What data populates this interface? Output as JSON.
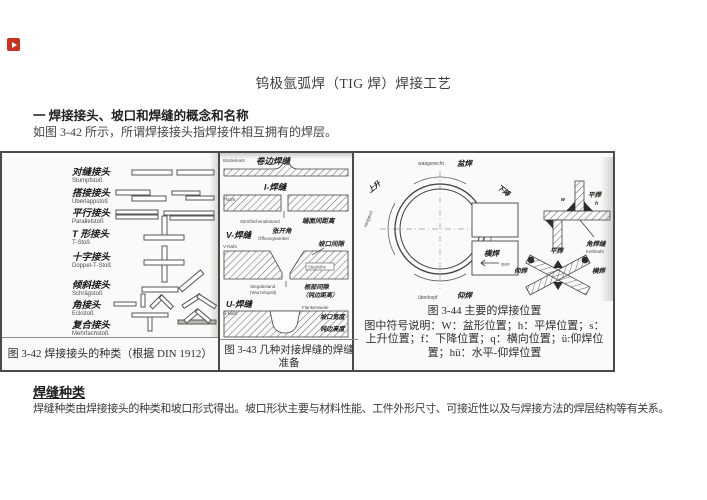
{
  "watermark": {
    "color": "#c8311f"
  },
  "title": "钨极氩弧焊（TIG 焊）焊接工艺",
  "section": {
    "heading": "一  焊接接头、坡口和焊缝的概念和名称",
    "intro": "如图 3-42 所示，所谓焊接接头指焊接件相互拥有的焊层。"
  },
  "figure_table": {
    "col1": {
      "caption": "图 3-42  焊接接头的种类（根据 DIN 1912）",
      "joints": [
        {
          "zh": "对缝接头",
          "de": "Stumpfstoß"
        },
        {
          "zh": "搭接接头",
          "de": "Überlappstoß"
        },
        {
          "zh": "平行接头",
          "de": "Parallelstoß"
        },
        {
          "zh": "T 形接头",
          "de": "T-Stoß"
        },
        {
          "zh": "十字接头",
          "de": "Doppel-T-Stoß"
        },
        {
          "zh": "倾斜接头",
          "de": "Schrägstoß"
        },
        {
          "zh": "角接头",
          "de": "Eckstoß"
        },
        {
          "zh": "复合接头",
          "de": "Mehrfachstoß"
        }
      ]
    },
    "col2": {
      "caption": "图 3-43  几种对接焊缝的焊缝准备",
      "labels": {
        "bordel_de": "Bördelnaht",
        "bordel_zh": "卷边焊缝",
        "i_zh": "I-焊缝",
        "i_de": "I-Naht",
        "gap_de": "Stirnflächenabstand",
        "gap_zh": "端面间距离",
        "angle_zh": "张开角",
        "angle_de": "Öffnungswinkel",
        "v_zh": "V-焊缝",
        "v_de": "V-Naht",
        "groove_zh": "坡口间隙",
        "steg_de": "Steghöhe",
        "root_de1": "Stegabstand",
        "root_de2": "(Wurzelspalt)",
        "root_zh1": "根部间隙",
        "root_zh2": "（钝边距离）",
        "u_zh": "U-焊缝",
        "u_de": "U-Naht",
        "flank_de": "Flankenweite",
        "flank_zh": "坡口宽度",
        "blunt_zh": "钝边高度"
      }
    },
    "col3": {
      "caption_title": "图 3-44  主要的焊接位置",
      "caption_legend": "图中符号说明：W：盆形位置；h：平焊位置；s：上升位置；f：下降位置；q：横向位置；ü:仰焊位置；hü：水平-仰焊位置",
      "labels": {
        "top_de": "waagerecht",
        "top_zh": "盆焊",
        "left_zh": "上升",
        "left_de": "steigend",
        "right_zh": "下降",
        "right_de": "fallend",
        "bottom_de": "überkopf",
        "bottom_zh": "仰焊",
        "quer_zh": "横焊",
        "quer_de": "quer",
        "w_letter": "w",
        "h_letter": "h",
        "fillet_zh": "平焊",
        "kehl_de": "Kehlnaht",
        "kehl_zh": "角焊缝",
        "x_top_zh": "平焊",
        "x_left_zh": "仰焊",
        "x_right_zh": "横焊"
      }
    }
  },
  "weld_types": {
    "heading": "焊缝种类",
    "body": "焊缝种类由焊接接头的种类和坡口形式得出。坡口形状主要与材料性能、工件外形尺寸、可接近性以及与焊接方法的焊层结构等有关系。"
  }
}
